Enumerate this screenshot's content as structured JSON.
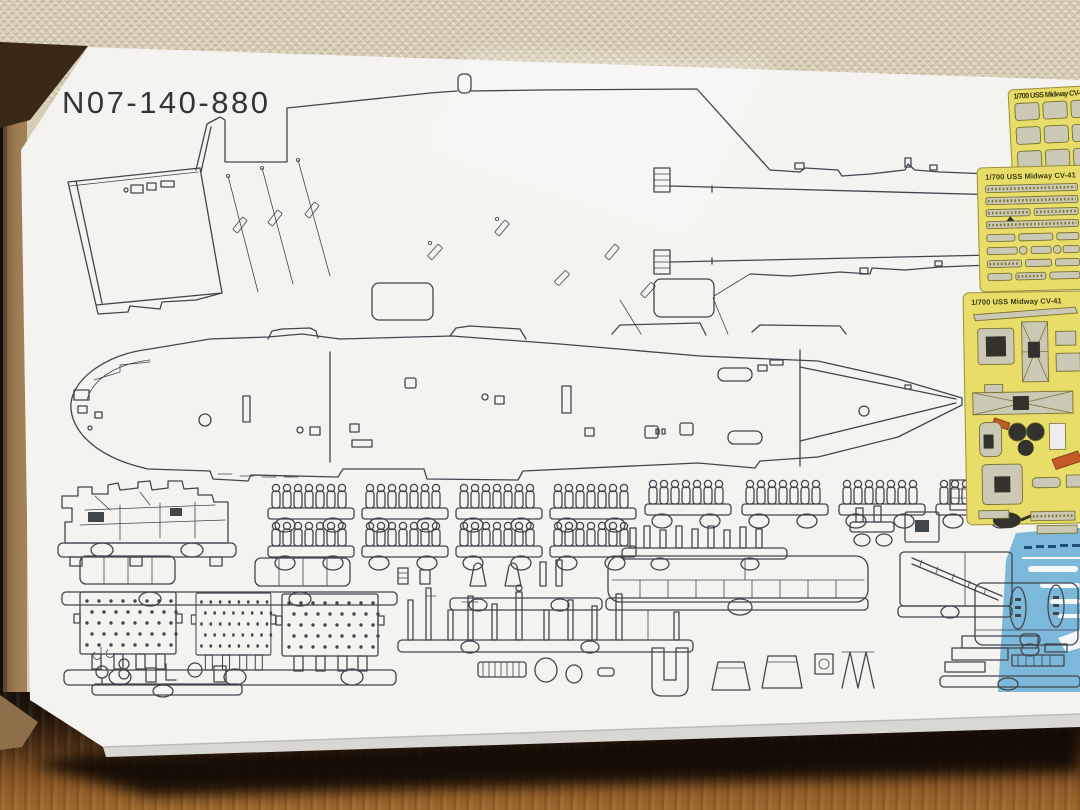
{
  "box": {
    "part_code": "N07-140-880"
  },
  "etch_sheets": [
    {
      "label": "1/700 USS Midway CV-41"
    },
    {
      "label": "1/700 USS Midway CV-41"
    },
    {
      "label": "1/700 USS Midway CV-41"
    }
  ],
  "colors": {
    "box_white": "#f4f3f0",
    "line_art": "#41464d",
    "fret_yellow": "#e7dd68",
    "etch_metal": "#ccc8b6",
    "sea_blue": "#7cb8da",
    "red_part": "#c25b28",
    "wood_floor": "#8a5626",
    "mat_beige": "#d8cdb5",
    "cardboard_tan": "#9b7b52"
  }
}
